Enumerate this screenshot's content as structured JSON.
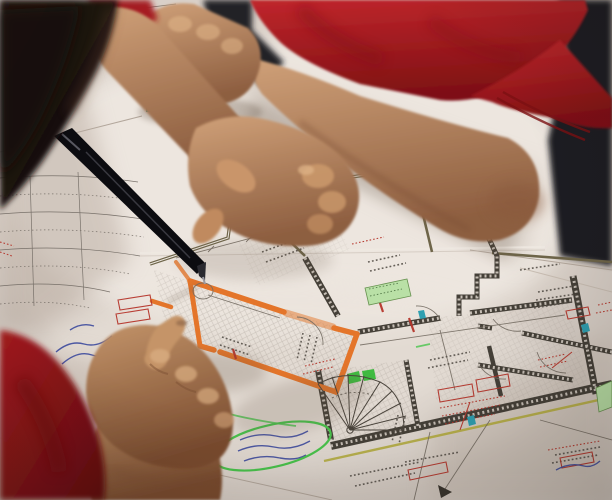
{
  "scene": {
    "description": "Photograph: two people in red polo shirts lean over a table, reviewing an architectural floor plan. One hand holds a black pen to the drawing; a second hand points at a room outlined in orange highlighter.",
    "plan_note": "Floor plan with dense, illegible small annotations, dimension chains, door swing arcs and a spiral staircase",
    "highlight_note": "Room walls traced in orange highlighter; green highlighter ellipse around a handwritten note"
  },
  "objects": {
    "photo": "Blueprint review photo",
    "background": "Dark room background",
    "paper": "Table covered with drawing sheets",
    "left_sheet": "Side sheet with dimension chains",
    "paper_stack": "Stacked sheet corners",
    "floor_plan": "Architectural floor plan drawing",
    "orange_room": "Room outlined with orange highlighter",
    "spiral_staircase": "Spiral staircase symbol",
    "green_labels": "Green highlighted label boxes",
    "green_circle": "Green highlighter ellipse around handwritten note",
    "handwriting": "Handwritten ink notes",
    "north_arrow": "North arrow symbol",
    "red_polo_person": "Person in red polo leaning on the plan",
    "resting_fist": "Resting fist on the sheets",
    "pen_hand": "Hand holding a black pen",
    "pen": "Black pen",
    "pointing_hand": "Hand pointing at the highlighted room",
    "foreground_head": "Out-of-focus head of foreground person",
    "foreground_shoulder": "Red shoulder of foreground person"
  },
  "colors": {
    "paper": "#d9d0c8",
    "paper_bright": "#f1ebe4",
    "paper_shadow": "#b4a69a",
    "background_dark": "#1d1e22",
    "plan_line": "#756d63",
    "plan_text": "#57514a",
    "wall_olive": "#6e6549",
    "wall_dark": "#454038",
    "wall_hatch": "#ded6cd",
    "orange_highlight": "#e4752a",
    "green_highlight": "#49c44c",
    "green_label": "#b9e0a6",
    "green_wedge": "#2fb832",
    "red_ink": "#b6362c",
    "blue_ink": "#3d4b9e",
    "cyan_marker": "#2e9fb0",
    "yellow_line": "#b5ad3f",
    "shirt_red": "#c0262c",
    "shirt_red_dark": "#7e1013",
    "shoulder_red": "#a81b20",
    "shoulder_red_dark": "#5f0a0e",
    "skin_light": "#cfa078",
    "skin_dark": "#8d5e40",
    "skin_mid": "#c3946a",
    "skin_shadow": "#7a4c2f",
    "hair": "#241812",
    "hair_dark": "#0f0b08",
    "pen_black": "#0c0c10",
    "shadow_warm": "#5f4d3d"
  }
}
